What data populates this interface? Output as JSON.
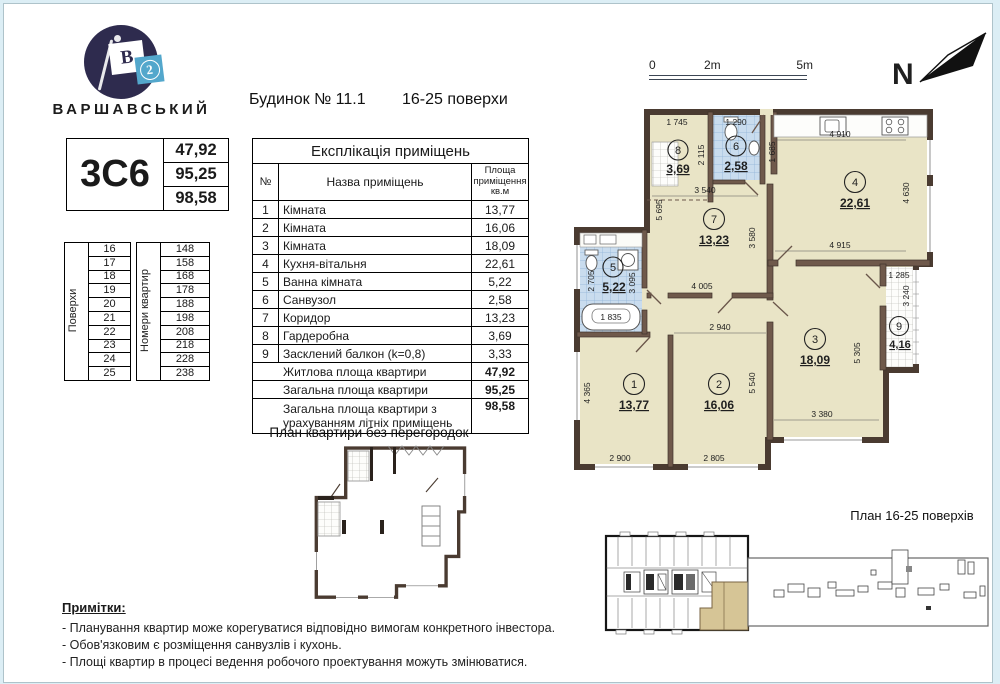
{
  "logo": {
    "flag_letter": "В",
    "flag_number": "2",
    "wordmark": "ВАРШАВСЬКИЙ"
  },
  "type_card": {
    "code": "3С6",
    "living_area": "47,92",
    "total_area": "95,25",
    "full_area": "98,58"
  },
  "floors_col": {
    "label": "Поверхи",
    "values": [
      "16",
      "17",
      "18",
      "19",
      "20",
      "21",
      "22",
      "23",
      "24",
      "25"
    ]
  },
  "apts_col": {
    "label": "Номери квартир",
    "values": [
      "148",
      "158",
      "168",
      "178",
      "188",
      "198",
      "208",
      "218",
      "228",
      "238"
    ]
  },
  "heading": {
    "building": "Будинок № 11.1",
    "floors": "16-25 поверхи"
  },
  "explication": {
    "title": "Експлікація приміщень",
    "col_num": "№",
    "col_name": "Назва приміщень",
    "col_area": "Площа приміщення кв.м",
    "rows": [
      {
        "num": "1",
        "name": "Кімната",
        "area": "13,77"
      },
      {
        "num": "2",
        "name": "Кімната",
        "area": "16,06"
      },
      {
        "num": "3",
        "name": "Кімната",
        "area": "18,09"
      },
      {
        "num": "4",
        "name": "Кухня-вітальня",
        "area": "22,61"
      },
      {
        "num": "5",
        "name": "Ванна кімната",
        "area": "5,22"
      },
      {
        "num": "6",
        "name": "Санвузол",
        "area": "2,58"
      },
      {
        "num": "7",
        "name": "Коридор",
        "area": "13,23"
      },
      {
        "num": "8",
        "name": "Гардеробна",
        "area": "3,69"
      },
      {
        "num": "9",
        "name": "Засклений балкон (k=0,8)",
        "area": "3,33"
      }
    ],
    "summary": [
      {
        "name": "Житлова площа квартири",
        "area": "47,92"
      },
      {
        "name": "Загальна площа квартири",
        "area": "95,25"
      },
      {
        "name": "Загальна площа квартири з урахуванням літніх приміщень",
        "area": "98,58"
      }
    ]
  },
  "open_plan_title": "План квартири без перегородок",
  "notes": {
    "title": "Примітки:",
    "items": [
      "- Планування квартир може корегуватися відповідно вимогам конкретного інвестора.",
      "- Обов'язковим є розміщення санвузлів і кухонь.",
      "- Площі квартир в процесі ведення робочого проектування можуть змінюватися."
    ]
  },
  "scale_bar": {
    "zero": "0",
    "two": "2m",
    "five": "5m"
  },
  "north_label": "N",
  "key_plan_title": "План 16-25 поверхів",
  "plan": {
    "rooms": [
      {
        "num": "1",
        "area": "13,77"
      },
      {
        "num": "2",
        "area": "16,06"
      },
      {
        "num": "3",
        "area": "18,09"
      },
      {
        "num": "4",
        "area": "22,61"
      },
      {
        "num": "5",
        "area": "5,22"
      },
      {
        "num": "6",
        "area": "2,58"
      },
      {
        "num": "7",
        "area": "13,23"
      },
      {
        "num": "8",
        "area": "3,69"
      },
      {
        "num": "9",
        "area": "4,16"
      }
    ],
    "dims": {
      "r8_top": "1 745",
      "r6_top": "1 290",
      "r8_right": "2 115",
      "entry_right": "1 685",
      "hall_top": "3 540",
      "kitchen_top": "4 910",
      "kitchen_right": "4 630",
      "kitchen_bottom": "4 915",
      "hall_left": "5 695",
      "hall_right": "3 580",
      "hall_bottom": "4 005",
      "balcony_top": "1 285",
      "balcony_right": "3 240",
      "room2_top": "2 940",
      "room2_right": "5 540",
      "room2_bottom": "2 805",
      "room3_right": "5 305",
      "room3_bottom": "3 380",
      "room1_left": "4 365",
      "room1_bottom": "2 900",
      "bath_left": "2 705",
      "bath_right": "3 095",
      "bathtub": "1 835"
    }
  }
}
